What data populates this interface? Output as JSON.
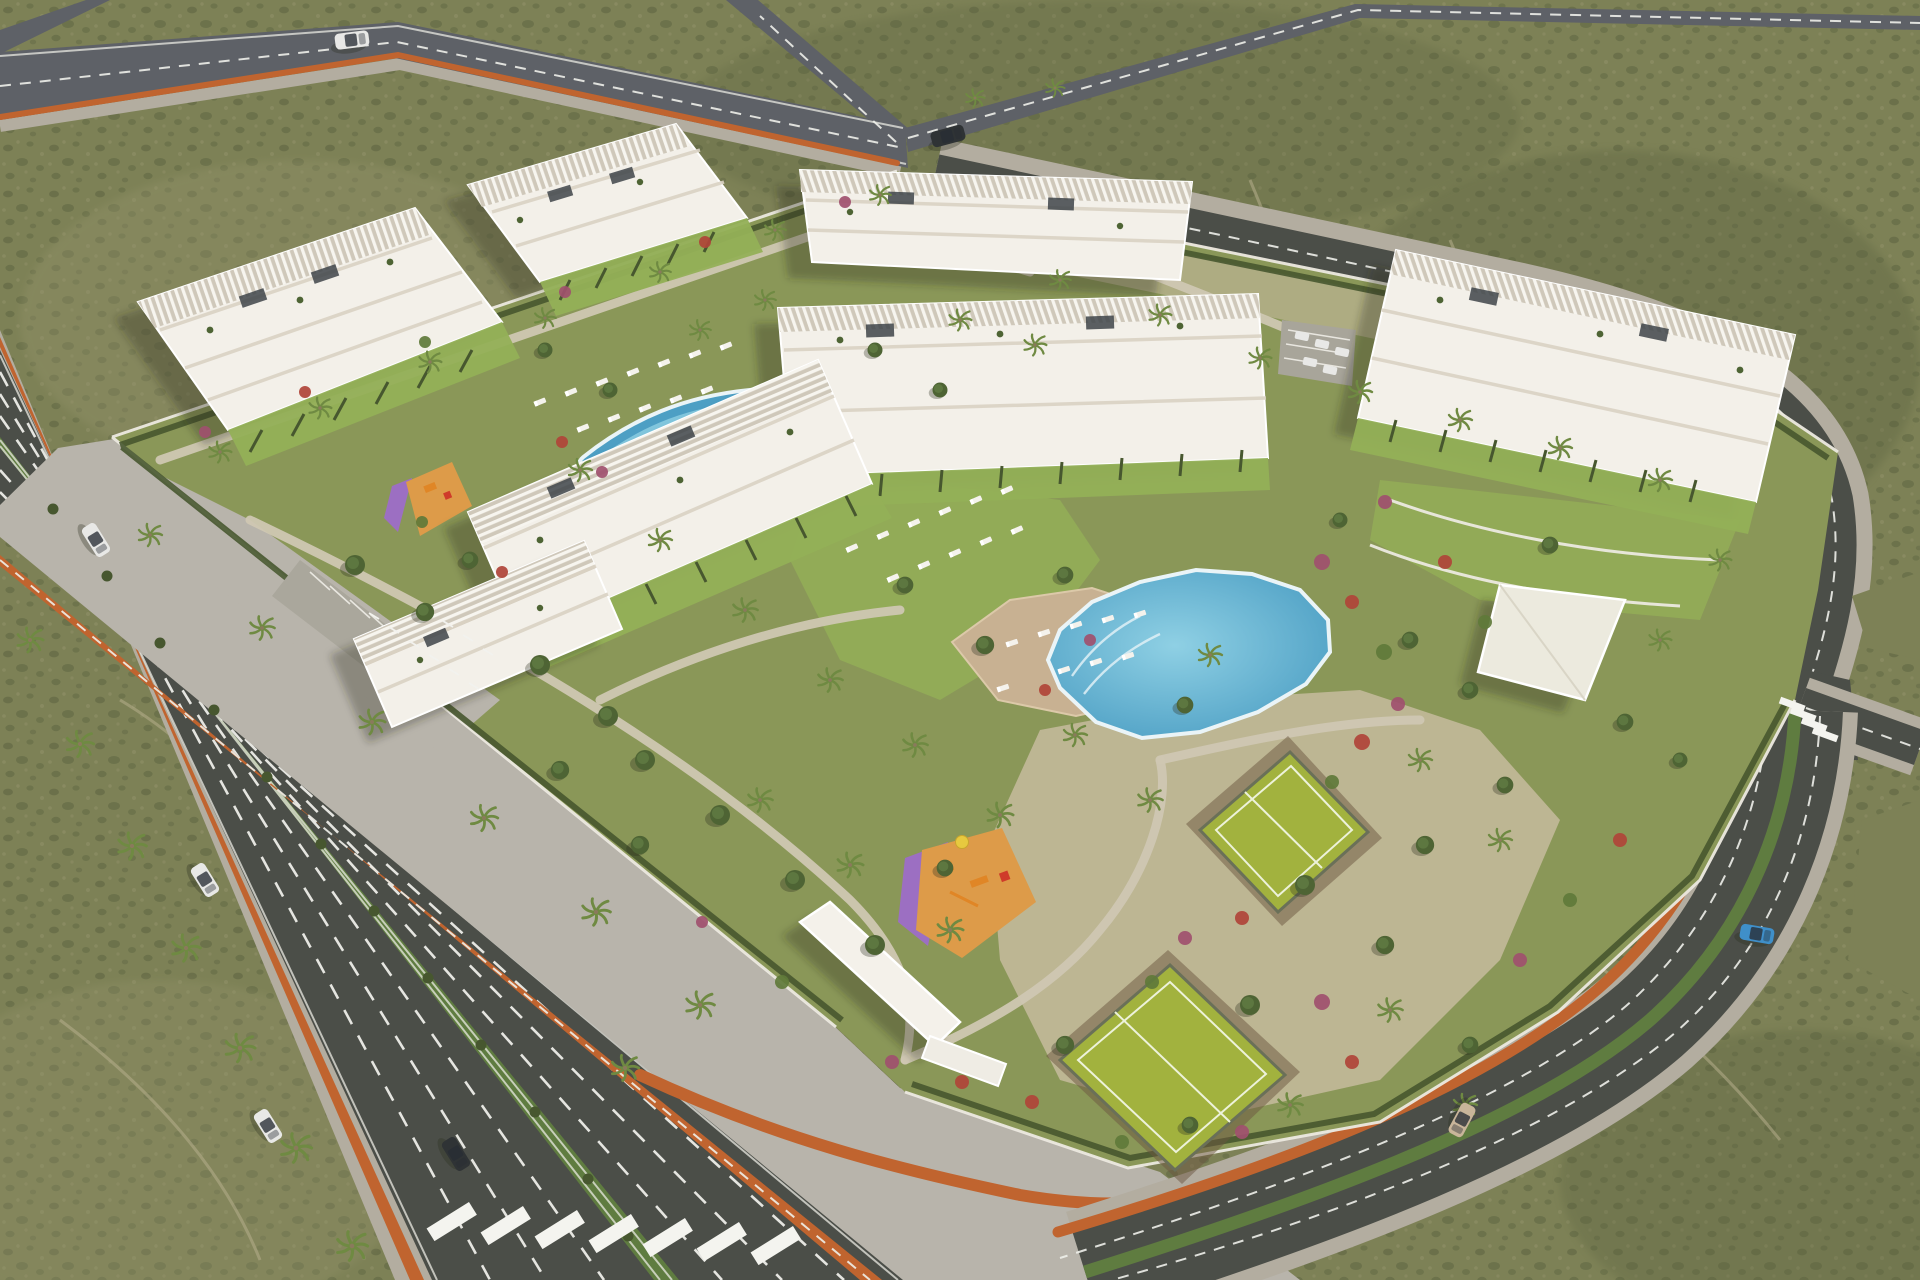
{
  "scene": {
    "type": "aerial-3d-architectural-render",
    "description": "Aerial rendering of a modern white apartment complex on a desert scrubland plot: seven terraced residential blocks, two swimming pools with sun loungers, two fenced tennis courts, orange-and-purple playgrounds, an entrance canopy, landscaped gardens with palm trees, and surrounding avenues with orange bike lanes, zebra crossings and cars."
  },
  "palette": {
    "scrub": "#7d8156",
    "scrubDark": "#5c6340",
    "scrubLight": "#95946c",
    "trail": "#b7ae8d",
    "asphalt": "#4b4e48",
    "asphaltLight": "#5e6167",
    "sidewalk": "#b3ada0",
    "plaza": "#b8b4ab",
    "pathLight": "#cfc7b2",
    "bikeLane": "#c0642f",
    "median": "#5f7c40",
    "lawn": "#8a9758",
    "lawnBright": "#94b057",
    "gravel": "#c6bb9e",
    "hedge": "#47572f",
    "wall": "#ece9e0",
    "building": "#f3f0e9",
    "buildingShade": "#d9d2c3",
    "terrace": "#c9bfa9",
    "solar": "#3e4449",
    "poolMain": "#4d9fc4",
    "poolLight": "#8fd0e4",
    "poolRim": "#eaf4f7",
    "deck": "#c8b192",
    "court": "#a2b23e",
    "courtLine": "#edf2da",
    "fence": "#6a7058",
    "playOrange": "#dd9b49",
    "playPurple": "#9c6fc2",
    "shrubPink": "#a0506e",
    "shrubRed": "#b04438",
    "shrubGreen": "#5f7a3a",
    "treeGreen": "#4e6434",
    "palmGreen": "#6f8a42",
    "trunk": "#8a7a5c",
    "carWhite": "#e8e8e6",
    "carDark": "#2f3335",
    "carBlue": "#3f8fc9",
    "carTan": "#c9b59a",
    "shadow": "rgba(42,48,32,0.32)"
  },
  "features": {
    "apartment_buildings": 7,
    "swimming_pools": 2,
    "tennis_courts": 2,
    "playgrounds": 2,
    "entrance_canopy": 1,
    "community_pavilion": 1,
    "parking_areas": 2,
    "crosswalks": 2,
    "vehicles": 8,
    "roads": [
      "highway-north",
      "avenue-southwest",
      "street-east",
      "curved-road-southeast"
    ]
  },
  "sprites": {
    "palms": [
      [
        30,
        640,
        1.1
      ],
      [
        80,
        744,
        1.15
      ],
      [
        132,
        846,
        1.2
      ],
      [
        186,
        948,
        1.2
      ],
      [
        240,
        1048,
        1.25
      ],
      [
        296,
        1148,
        1.3
      ],
      [
        352,
        1246,
        1.3
      ],
      [
        150,
        535,
        1.0
      ],
      [
        262,
        628,
        1.05
      ],
      [
        372,
        722,
        1.1
      ],
      [
        484,
        818,
        1.15
      ],
      [
        596,
        912,
        1.2
      ],
      [
        700,
        1005,
        1.2
      ],
      [
        625,
        1068,
        1.15
      ],
      [
        220,
        452,
        0.95
      ],
      [
        320,
        408,
        0.95
      ],
      [
        430,
        362,
        0.95
      ],
      [
        545,
        318,
        0.9
      ],
      [
        660,
        272,
        0.9
      ],
      [
        775,
        230,
        0.9
      ],
      [
        880,
        195,
        0.9
      ],
      [
        765,
        300,
        0.9
      ],
      [
        700,
        330,
        0.9
      ],
      [
        960,
        320,
        0.95
      ],
      [
        1035,
        345,
        0.95
      ],
      [
        1060,
        280,
        0.9
      ],
      [
        1160,
        315,
        0.95
      ],
      [
        1260,
        358,
        0.95
      ],
      [
        1360,
        392,
        1.0
      ],
      [
        1460,
        420,
        1.0
      ],
      [
        1560,
        448,
        1.0
      ],
      [
        1660,
        480,
        1.0
      ],
      [
        580,
        470,
        1.0
      ],
      [
        660,
        540,
        1.0
      ],
      [
        745,
        610,
        1.05
      ],
      [
        830,
        680,
        1.05
      ],
      [
        915,
        745,
        1.05
      ],
      [
        1000,
        815,
        1.1
      ],
      [
        760,
        800,
        1.05
      ],
      [
        850,
        865,
        1.1
      ],
      [
        950,
        930,
        1.1
      ],
      [
        1210,
        655,
        1.0
      ],
      [
        1075,
        735,
        1.0
      ],
      [
        1150,
        800,
        1.05
      ],
      [
        1420,
        760,
        1.0
      ],
      [
        1500,
        840,
        1.0
      ],
      [
        1390,
        1010,
        1.05
      ],
      [
        1290,
        1105,
        1.05
      ],
      [
        1465,
        1105,
        1.0
      ],
      [
        975,
        98,
        0.8
      ],
      [
        1055,
        88,
        0.8
      ],
      [
        1720,
        560,
        0.95
      ],
      [
        1660,
        640,
        0.95
      ]
    ],
    "trees": [
      [
        355,
        565,
        12
      ],
      [
        425,
        612,
        11
      ],
      [
        540,
        665,
        12
      ],
      [
        608,
        716,
        12
      ],
      [
        470,
        560,
        10
      ],
      [
        645,
        760,
        12
      ],
      [
        720,
        815,
        12
      ],
      [
        795,
        880,
        12
      ],
      [
        875,
        945,
        12
      ],
      [
        640,
        845,
        11
      ],
      [
        560,
        770,
        11
      ],
      [
        985,
        645,
        11
      ],
      [
        905,
        585,
        10
      ],
      [
        1065,
        575,
        10
      ],
      [
        1185,
        705,
        10
      ],
      [
        1305,
        885,
        12
      ],
      [
        1250,
        1005,
        12
      ],
      [
        1425,
        845,
        11
      ],
      [
        1505,
        785,
        10
      ],
      [
        1385,
        945,
        11
      ],
      [
        1470,
        1045,
        10
      ],
      [
        1190,
        1125,
        10
      ],
      [
        1065,
        1045,
        11
      ],
      [
        945,
        868,
        10
      ],
      [
        1625,
        722,
        10
      ],
      [
        1680,
        760,
        9
      ],
      [
        875,
        350,
        9
      ],
      [
        940,
        390,
        9
      ],
      [
        545,
        350,
        9
      ],
      [
        610,
        390,
        9
      ],
      [
        1410,
        640,
        10
      ],
      [
        1470,
        690,
        10
      ],
      [
        1550,
        545,
        10
      ],
      [
        1340,
        520,
        9
      ]
    ],
    "shrubs": [
      [
        1322,
        562,
        "shrubPink",
        8
      ],
      [
        1352,
        602,
        "shrubRed",
        7
      ],
      [
        1384,
        652,
        "shrubGreen",
        8
      ],
      [
        1398,
        704,
        "shrubPink",
        7
      ],
      [
        1362,
        742,
        "shrubRed",
        8
      ],
      [
        1332,
        782,
        "shrubGreen",
        7
      ],
      [
        1185,
        938,
        "shrubPink",
        7
      ],
      [
        1242,
        918,
        "shrubRed",
        7
      ],
      [
        1152,
        982,
        "shrubGreen",
        7
      ],
      [
        1322,
        1002,
        "shrubPink",
        8
      ],
      [
        1352,
        1062,
        "shrubRed",
        7
      ],
      [
        1242,
        1132,
        "shrubPink",
        7
      ],
      [
        1122,
        1142,
        "shrubGreen",
        7
      ],
      [
        1032,
        1102,
        "shrubRed",
        7
      ],
      [
        205,
        432,
        "shrubPink",
        6
      ],
      [
        305,
        392,
        "shrubRed",
        6
      ],
      [
        425,
        342,
        "shrubGreen",
        6
      ],
      [
        565,
        292,
        "shrubPink",
        6
      ],
      [
        705,
        242,
        "shrubRed",
        6
      ],
      [
        845,
        202,
        "shrubPink",
        6
      ],
      [
        1385,
        502,
        "shrubPink",
        7
      ],
      [
        1445,
        562,
        "shrubRed",
        7
      ],
      [
        1485,
        622,
        "shrubGreen",
        7
      ],
      [
        892,
        1062,
        "shrubPink",
        7
      ],
      [
        962,
        1082,
        "shrubRed",
        7
      ],
      [
        782,
        982,
        "shrubGreen",
        7
      ],
      [
        702,
        922,
        "shrubPink",
        6
      ],
      [
        602,
        472,
        "shrubPink",
        6
      ],
      [
        562,
        442,
        "shrubRed",
        6
      ],
      [
        422,
        522,
        "shrubGreen",
        6
      ],
      [
        502,
        572,
        "shrubRed",
        6
      ],
      [
        1090,
        640,
        "shrubPink",
        6
      ],
      [
        1045,
        690,
        "shrubRed",
        6
      ],
      [
        1570,
        900,
        "shrubGreen",
        7
      ],
      [
        1520,
        960,
        "shrubPink",
        7
      ],
      [
        1620,
        840,
        "shrubRed",
        7
      ]
    ],
    "medianBushes": [
      [
        53,
        509
      ],
      [
        107,
        576
      ],
      [
        160,
        643
      ],
      [
        214,
        710
      ],
      [
        267,
        777
      ],
      [
        321,
        844
      ],
      [
        374,
        911
      ],
      [
        428,
        978
      ],
      [
        481,
        1045
      ],
      [
        535,
        1112
      ],
      [
        588,
        1179
      ],
      [
        628,
        1236
      ]
    ],
    "loungersUpper": [
      [
        540,
        402
      ],
      [
        571,
        392
      ],
      [
        602,
        382
      ],
      [
        633,
        372
      ],
      [
        664,
        363
      ],
      [
        695,
        354
      ],
      [
        726,
        346
      ],
      [
        583,
        428
      ],
      [
        614,
        418
      ],
      [
        645,
        408
      ],
      [
        676,
        399
      ],
      [
        707,
        390
      ]
    ],
    "loungersGrass": [
      [
        852,
        548
      ],
      [
        883,
        535
      ],
      [
        914,
        523
      ],
      [
        945,
        511
      ],
      [
        976,
        500
      ],
      [
        1007,
        490
      ],
      [
        893,
        578
      ],
      [
        924,
        565
      ],
      [
        955,
        553
      ],
      [
        986,
        541
      ],
      [
        1017,
        530
      ]
    ],
    "loungersDeck": [
      [
        1012,
        643
      ],
      [
        1044,
        633
      ],
      [
        1076,
        625
      ],
      [
        1108,
        619
      ],
      [
        1140,
        614
      ],
      [
        1064,
        670
      ],
      [
        1096,
        662
      ],
      [
        1128,
        656
      ],
      [
        1003,
        688
      ]
    ],
    "cars": [
      [
        96,
        540,
        58,
        "carWhite"
      ],
      [
        205,
        880,
        58,
        "carWhite"
      ],
      [
        268,
        1126,
        58,
        "carWhite"
      ],
      [
        456,
        1154,
        58,
        "carDark"
      ],
      [
        948,
        136,
        -15,
        "carDark"
      ],
      [
        352,
        40,
        -7,
        "carWhite"
      ],
      [
        1462,
        1120,
        118,
        "carTan"
      ],
      [
        1757,
        934,
        10,
        "carBlue"
      ]
    ],
    "parkedCars": [
      [
        1302,
        336,
        12
      ],
      [
        1322,
        344,
        12
      ],
      [
        1342,
        352,
        12
      ],
      [
        1310,
        362,
        12
      ],
      [
        1330,
        370,
        12
      ]
    ],
    "bikeRacks": [
      [
        374,
        616
      ],
      [
        394,
        630
      ],
      [
        414,
        644
      ],
      [
        434,
        658
      ],
      [
        454,
        672
      ],
      [
        474,
        686
      ],
      [
        448,
        624
      ],
      [
        468,
        638
      ],
      [
        488,
        652
      ]
    ]
  }
}
